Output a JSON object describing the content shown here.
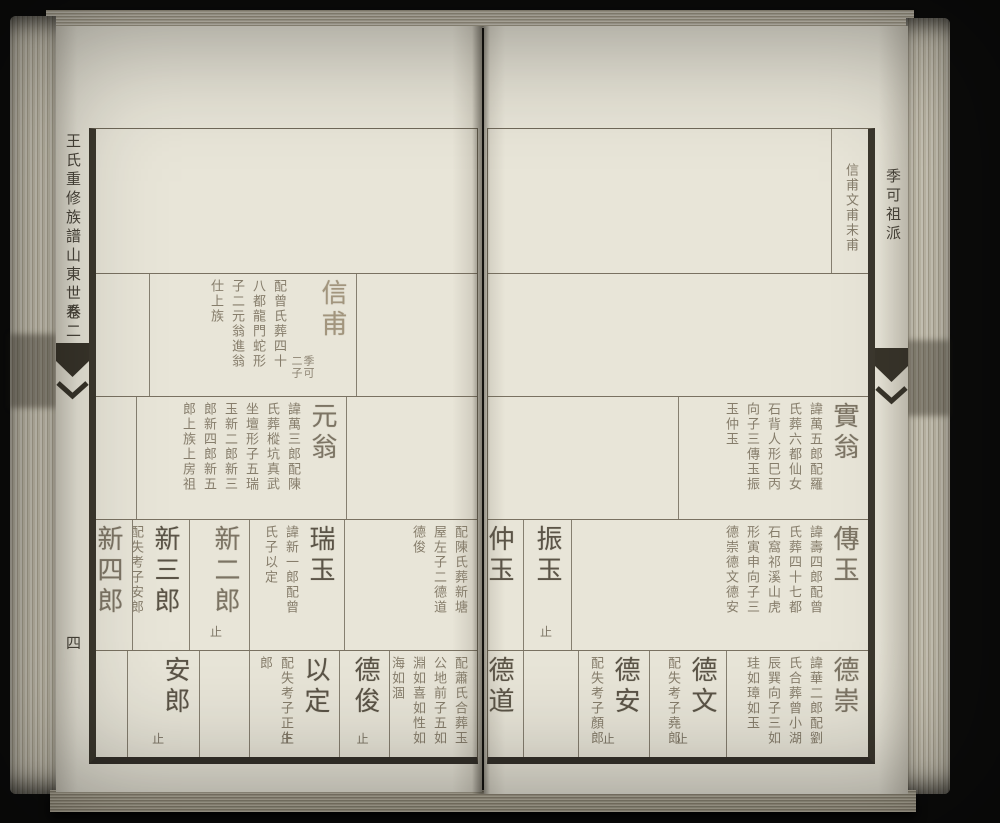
{
  "book": {
    "spine_title": "王氏重修族譜山東世系",
    "volume_label": "卷二",
    "page_number": "四",
    "branch_label": "季可祖派",
    "paper_color": "#e8e5d8",
    "ink_color": "#5b5447",
    "frame_color": "#3c382e"
  },
  "left_page": {
    "rows": [
      {
        "cells": []
      },
      {
        "cells": [
          {
            "type": "spacer"
          },
          {
            "type": "entry",
            "name": "信甫",
            "annotation": "季可二子",
            "tone": "faint",
            "bio": "配曾氏葬四十八都龍門蛇形子二元翁進翁仕上族"
          }
        ]
      },
      {
        "cells": [
          {
            "type": "spacer"
          },
          {
            "type": "entry",
            "name": "元翁",
            "tone": "mid",
            "bio": "諱萬三郎配陳氏葬樅坑真武坐壇形子五瑞玉新二郎新三郎新四郎新五郎上族上房祖"
          }
        ]
      },
      {
        "cells": [
          {
            "type": "continuation",
            "bio": "配陳氏葬新塘屋左子二德道德俊"
          },
          {
            "type": "entry",
            "name": "瑞玉",
            "tone": "dark",
            "bio": "諱新一郎配曾氏子以定"
          },
          {
            "type": "entry",
            "name": "新二郎",
            "tone": "mid",
            "stop": "止"
          },
          {
            "type": "entry",
            "name": "新三郎",
            "tone": "dark",
            "bio": "配失考子安郎"
          },
          {
            "type": "entry",
            "name": "新四郎",
            "tone": "mid"
          }
        ]
      },
      {
        "cells": [
          {
            "type": "continuation",
            "bio": "配蕭氏合葬玉公地前子五如淵如喜如性如海如涸"
          },
          {
            "type": "entry",
            "name": "德俊",
            "tone": "dark",
            "stop": "止"
          },
          {
            "type": "entry",
            "name": "以定",
            "tone": "dark",
            "bio": "配失考子正生郎",
            "stop": "止"
          },
          {
            "type": "spacer"
          },
          {
            "type": "entry",
            "name": "安郎",
            "tone": "dark",
            "stop": "止"
          },
          {
            "type": "spacer"
          }
        ]
      }
    ]
  },
  "right_page": {
    "rows": [
      {
        "cells": [
          {
            "type": "continuation",
            "bio": "信甫文甫末甫"
          }
        ]
      },
      {
        "cells": []
      },
      {
        "cells": [
          {
            "type": "entry",
            "name": "實翁",
            "tone": "mid",
            "bio": "諱萬五郎配羅氏葬六都仙女石背人形巳丙向子三傳玉振玉仲玉"
          }
        ]
      },
      {
        "cells": [
          {
            "type": "entry",
            "name": "傳玉",
            "tone": "mid",
            "bio": "諱壽四郎配曾氏葬四十七都石窩祁溪山虎形寅申向子三德崇德文德安"
          },
          {
            "type": "entry",
            "name": "振玉",
            "tone": "dark",
            "stop": "止"
          },
          {
            "type": "entry",
            "name": "仲玉",
            "tone": "dark"
          }
        ]
      },
      {
        "cells": [
          {
            "type": "entry",
            "name": "德崇",
            "tone": "mid",
            "bio": "諱華二郎配劉氏合葬曾小湖辰巽向子三如珪如璋如玉"
          },
          {
            "type": "entry",
            "name": "德文",
            "tone": "dark",
            "bio": "配失考子堯郎",
            "stop": "止"
          },
          {
            "type": "entry",
            "name": "德安",
            "tone": "dark",
            "bio": "配失考子顏郎",
            "stop": "止"
          },
          {
            "type": "spacer"
          },
          {
            "type": "entry",
            "name": "德道",
            "tone": "dark"
          }
        ]
      }
    ]
  }
}
